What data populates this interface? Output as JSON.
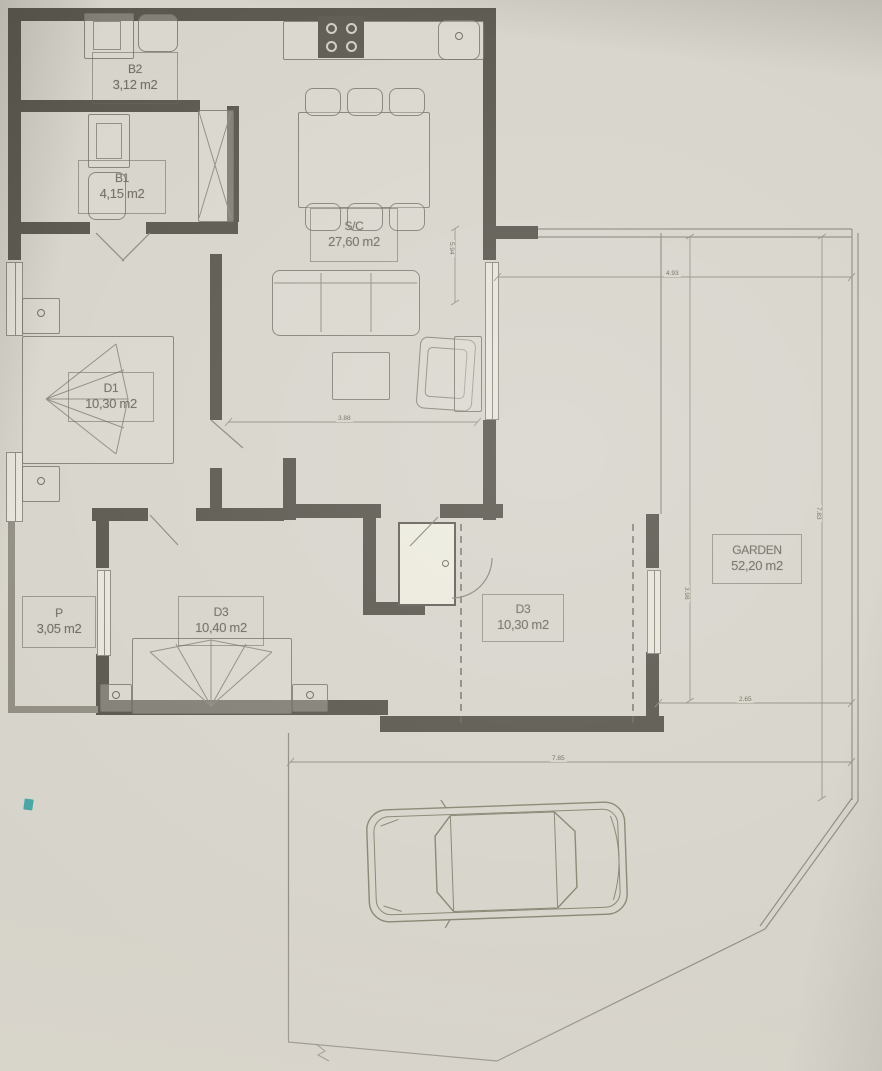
{
  "rooms": [
    {
      "code": "B2",
      "area": "3,12 m2"
    },
    {
      "code": "B1",
      "area": "4,15 m2"
    },
    {
      "code": "S/C",
      "area": "27,60 m2"
    },
    {
      "code": "D1",
      "area": "10,30 m2"
    },
    {
      "code": "P",
      "area": "3,05 m2"
    },
    {
      "code": "D3",
      "area": "10,40 m2"
    },
    {
      "code": "D3",
      "area": "10,30 m2"
    },
    {
      "code": "GARDEN",
      "area": "52,20 m2"
    }
  ],
  "dimensions": {
    "living_width": "3.88",
    "veranda_top": "4.93",
    "living_height": "5.94",
    "garden_right": "7.83",
    "garden_height": "3.98",
    "garden_bottom": "2.65",
    "parking_width": "7.85"
  },
  "features": {
    "furniture": [
      "kitchen-counter",
      "stove",
      "sink",
      "dining-table",
      "six-chairs",
      "sofa",
      "coffee-table",
      "armchair",
      "console",
      "double-bed-d1",
      "double-bed-d3",
      "nightstands",
      "wardrobe",
      "toilets",
      "washbasins",
      "utility-closet",
      "car-top-view"
    ],
    "outdoor": [
      "garden",
      "veranda",
      "parking-with-car"
    ]
  },
  "colors": {
    "paper": "#d6d3ca",
    "wall": "#57544b",
    "linework": "#8f8b7f",
    "label_text": "#6f6b60",
    "scan_mark_teal": "#2f9ba0"
  }
}
